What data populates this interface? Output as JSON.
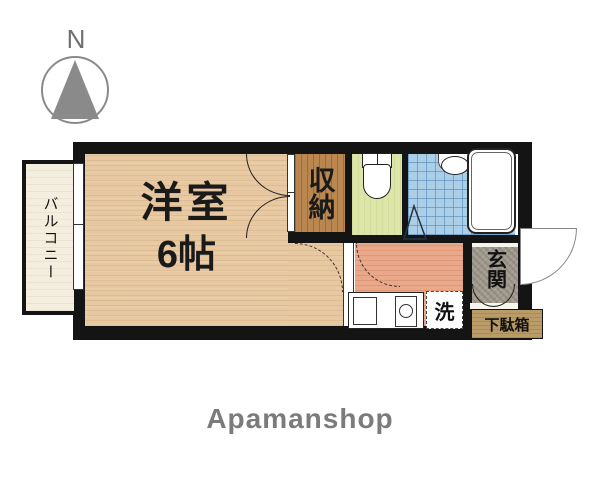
{
  "compass": {
    "label": "N"
  },
  "plan": {
    "balcony": {
      "label": "バルコニー"
    },
    "main_room": {
      "name": "洋室",
      "size": "6帖"
    },
    "closet": {
      "label": "収納"
    },
    "entrance": {
      "label": "玄関"
    },
    "washer": {
      "label": "洗"
    },
    "shoe_cabinet": {
      "label": "下駄箱"
    }
  },
  "footer": {
    "brand": "Apamanshop"
  },
  "colors": {
    "wall": "#141414",
    "wood": "#e7c8a0",
    "closet_wood": "#b9874f",
    "toilet_floor": "#dde6a8",
    "bath_tile": "#abcfe6",
    "kitchen_floor": "#eaa88a",
    "entrance_floor": "#a19a8e",
    "balcony_floor": "#f3eedd",
    "shoe_cabinet": "#b89b66",
    "compass": "#8a8a8a",
    "brand": "#7b7b7b"
  }
}
